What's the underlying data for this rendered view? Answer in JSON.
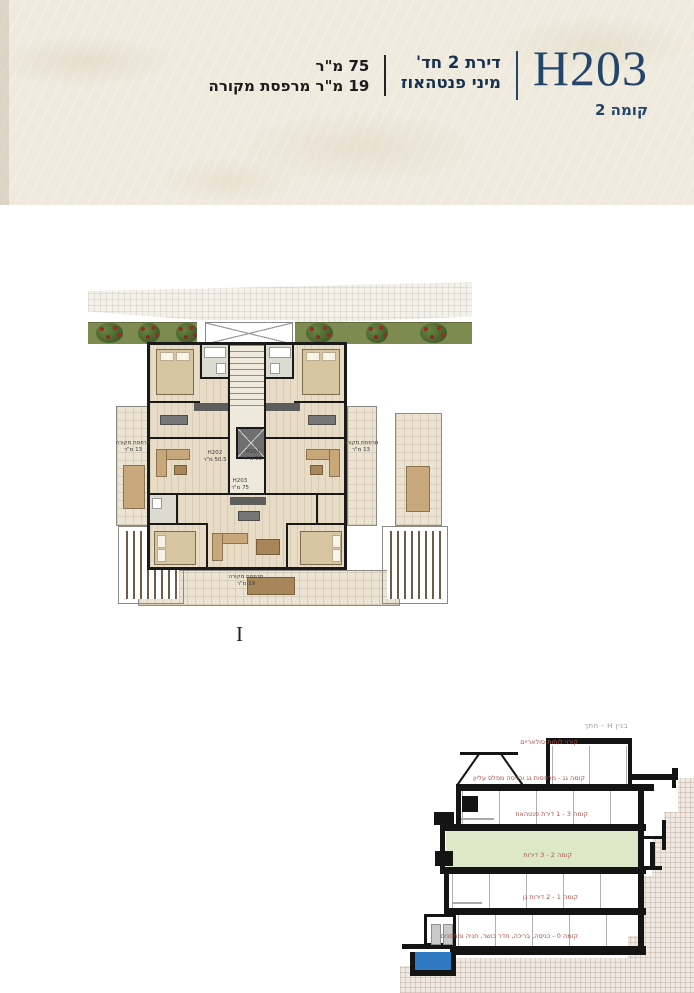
{
  "header": {
    "unit_code": "H203",
    "floor_label": "קומה 2",
    "type_line1": "דירת 2 חד'",
    "type_line2": "מיני פנטהאוז",
    "size_line1": "75 מ\"ר",
    "size_line2": "19 מ\"ר מרפסת מקורה"
  },
  "plan": {
    "units": [
      {
        "code": "H202",
        "area": "50.5 מ\"ר"
      },
      {
        "code": "H201",
        "area": "50 מ\"ר"
      },
      {
        "code": "H203",
        "area": "75 מ\"ר"
      }
    ],
    "balcony_left": [
      "מרפסת מקורה",
      "13 מ\"ר"
    ],
    "balcony_right": [
      "מרפסת מקורה",
      "13 מ\"ר"
    ],
    "balcony_bottom": [
      "מרפסת מקורה",
      "19 מ\"ר"
    ],
    "section_marker": "I"
  },
  "section": {
    "title": "בנין H - חתך",
    "floor_labels": [
      "קירוי לוחות סולאריים",
      "קומה גג - מרפסות גג וכניסה מפלס עליון",
      "קומה 3 - 1 דירת פנטהאוז",
      "קומה 2 - 3 דירות",
      "קומה 1 - 2 דירות גן",
      "קומה 0 - כניסה, בריכה, חדר כושר, חניה ומחסנים"
    ]
  },
  "colors": {
    "navy": "#24456b",
    "paper": "#efeadd",
    "label_red": "#a8544a",
    "highlight_green": "#dce8c8",
    "pool_blue": "#2e79c1",
    "planting_olive": "#7d8a50"
  }
}
